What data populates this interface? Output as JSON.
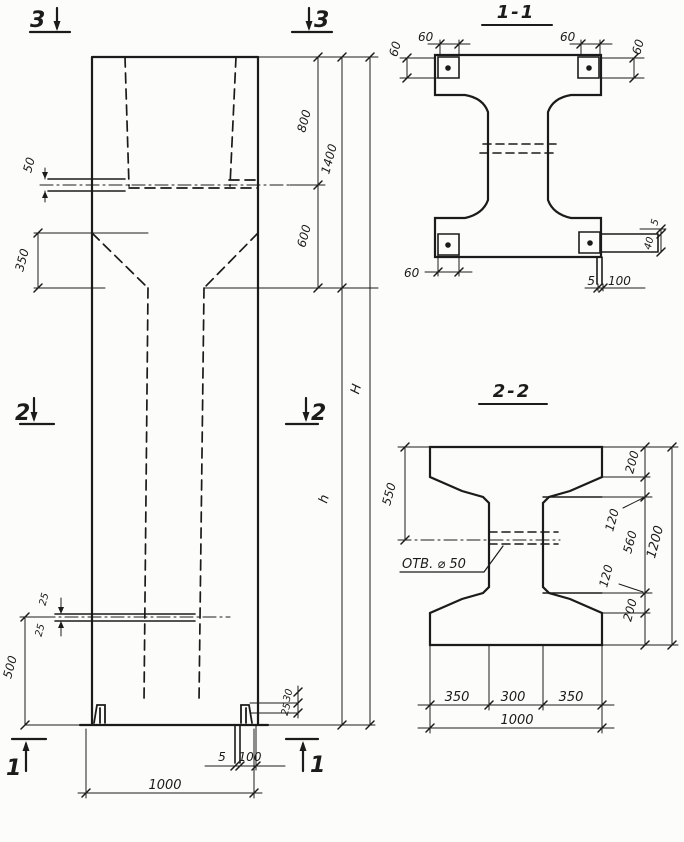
{
  "canvas": {
    "bg": "#fcfcfa",
    "ink": "#1b1b1b"
  },
  "elevation": {
    "markers": {
      "top": "3",
      "middle": "2",
      "bottom": "1"
    },
    "dims": {
      "capital_hole": "50",
      "haunch": "350",
      "top_zone": "800",
      "taper_zone": "600",
      "capital_total": "1400",
      "shaft": "h",
      "total": "H",
      "base_zone": "500",
      "hole_offset_upper": "25",
      "hole_offset_lower": "25",
      "corner_upper": "30",
      "corner_lower": "25",
      "plate_thickness": "5",
      "plate_width": "100",
      "width": "1000"
    }
  },
  "section_1_1": {
    "title": "1-1",
    "dims": {
      "plate_tl_w": "60",
      "plate_tl_h": "60",
      "plate_tr_w": "60",
      "plate_tr_h": "60",
      "plate_bl_w": "60",
      "plate_br_t": "5",
      "plate_br_w": "100",
      "side_gap": "5",
      "side_leg": "40"
    }
  },
  "section_2_2": {
    "title": "2-2",
    "hole_label": "ОТВ. ⌀ 50",
    "dims": {
      "top_to_hole": "550",
      "flange_top": "200",
      "taper_top": "120",
      "web_clear": "560",
      "taper_bottom": "120",
      "flange_bottom": "200",
      "height": "1200",
      "overhang_left": "350",
      "web": "300",
      "overhang_right": "350",
      "width": "1000"
    }
  }
}
